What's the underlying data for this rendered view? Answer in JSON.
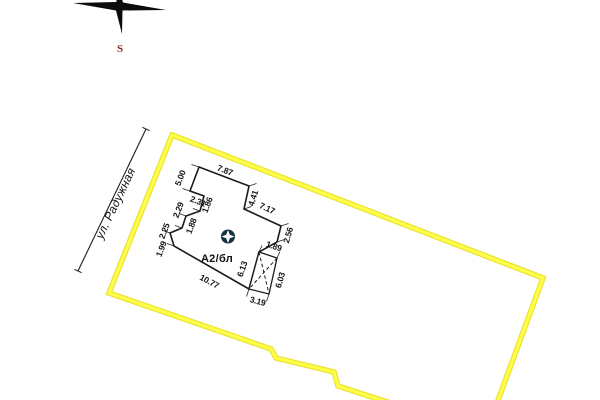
{
  "compass": {
    "south_label": "S"
  },
  "street": {
    "name": "ул. Радужная"
  },
  "parcel": {
    "note": "land plot boundary"
  },
  "building": {
    "label": "А2/бл",
    "dims": {
      "top": "7.87",
      "left_upper": "5.00",
      "notch_width": "2.31",
      "notch_height": "1.86",
      "right_upper": "4.41",
      "right_diagonal": "7.17",
      "left_step1": "2.29",
      "left_inner": "1.88",
      "right_side": "2.56",
      "left_step2": "2.25",
      "left_lower": "1.99",
      "annex_top": "1.89",
      "annex_left": "6.13",
      "annex_right": "6.03",
      "main_bottom": "10.77",
      "annex_bottom": "3.19"
    }
  },
  "colors": {
    "parcel_boundary": "#FDFD4A",
    "parcel_boundary_edge": "#E9DF2A",
    "marker": "#17333F",
    "compass_south": "#8B1E1E"
  }
}
